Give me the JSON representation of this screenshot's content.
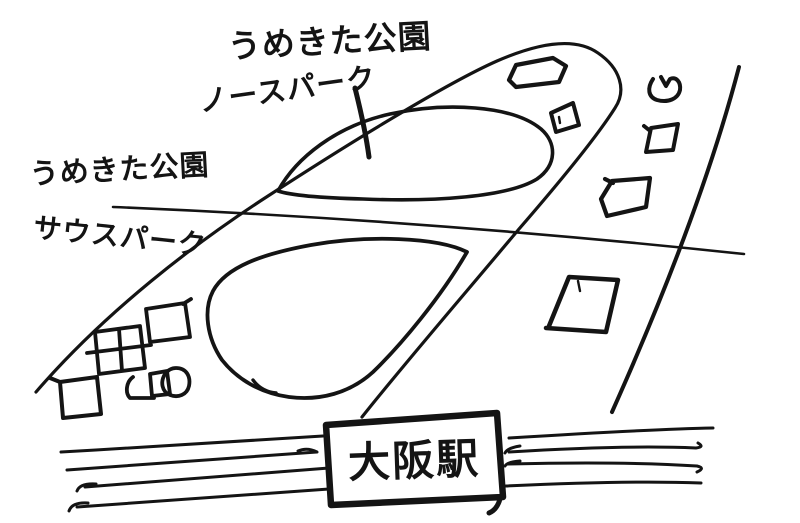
{
  "page": {
    "background": "#ffffff",
    "ink": "#141414",
    "type": "hand-drawn sketch map"
  },
  "labels": {
    "north_park": {
      "line1": "うめきた公園",
      "line2": "ノースパーク"
    },
    "south_park": {
      "line1": "うめきた公園",
      "line2": "サウスパーク"
    },
    "station": {
      "name": "大阪駅"
    }
  }
}
